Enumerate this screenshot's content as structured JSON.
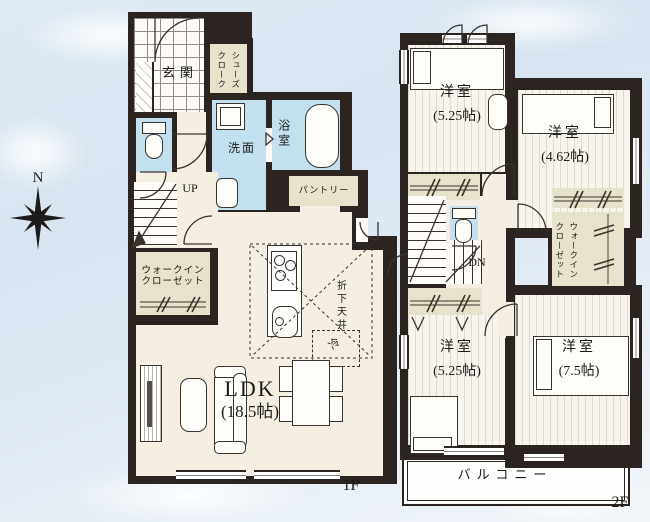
{
  "compass": {
    "label": "N"
  },
  "floor1": {
    "floor_label": "1F",
    "entrance": "玄関",
    "shoes_closet": {
      "right_col": "シューズ",
      "left_col": "クローク"
    },
    "washroom": "洗面",
    "bathroom": "浴室",
    "pantry": "パントリー",
    "stairs_label": "UP",
    "walk_in_closet": {
      "line1": "ウォークイン",
      "line2": "クローゼット"
    },
    "ldk": {
      "name": "LDK",
      "size": "(18.5帖)"
    },
    "dropped_ceiling": "折下天井",
    "refrigerator": "冷"
  },
  "floor2": {
    "floor_label": "2F",
    "stairs_label": "DN",
    "bedroom_top_left": {
      "name": "洋室",
      "size": "(5.25帖)"
    },
    "bedroom_top_right": {
      "name": "洋室",
      "size": "(4.62帖)"
    },
    "bedroom_bottom_left": {
      "name": "洋室",
      "size": "(5.25帖)"
    },
    "bedroom_bottom_right": {
      "name": "洋室",
      "size": "(7.5帖)"
    },
    "walk_in_closet": {
      "right_col": "ウォークイン",
      "left_col": "クローゼット"
    },
    "balcony": "バルコニー"
  },
  "colors": {
    "wall": "#2b2420",
    "floor_cream": "#f4efe2",
    "wet_area_blue": "#c2e0ee",
    "closet_beige": "#e6e2cb",
    "sky": "#d7e4f0"
  }
}
